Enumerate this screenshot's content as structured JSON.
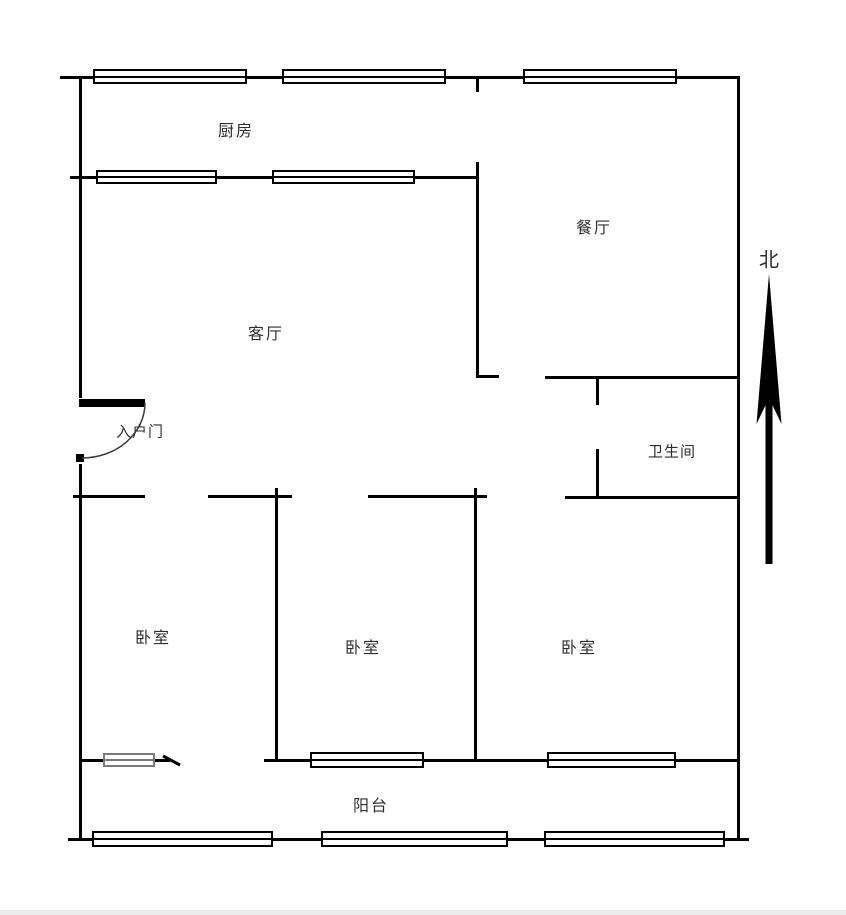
{
  "floorplan": {
    "rooms": {
      "kitchen": {
        "label": "厨房"
      },
      "dining": {
        "label": "餐厅"
      },
      "living": {
        "label": "客厅"
      },
      "entry_door": {
        "label": "入户门"
      },
      "bathroom": {
        "label": "卫生间"
      },
      "bedroom_left": {
        "label": "卧室"
      },
      "bedroom_middle": {
        "label": "卧室"
      },
      "bedroom_right": {
        "label": "卧室"
      },
      "balcony": {
        "label": "阳台"
      }
    },
    "compass": {
      "label": "北",
      "icon": "north-arrow-icon"
    },
    "colors": {
      "wall": "#000000",
      "text": "#2e2e2e",
      "secondary_window": "#7a7a7a",
      "background": "#ffffff"
    }
  }
}
